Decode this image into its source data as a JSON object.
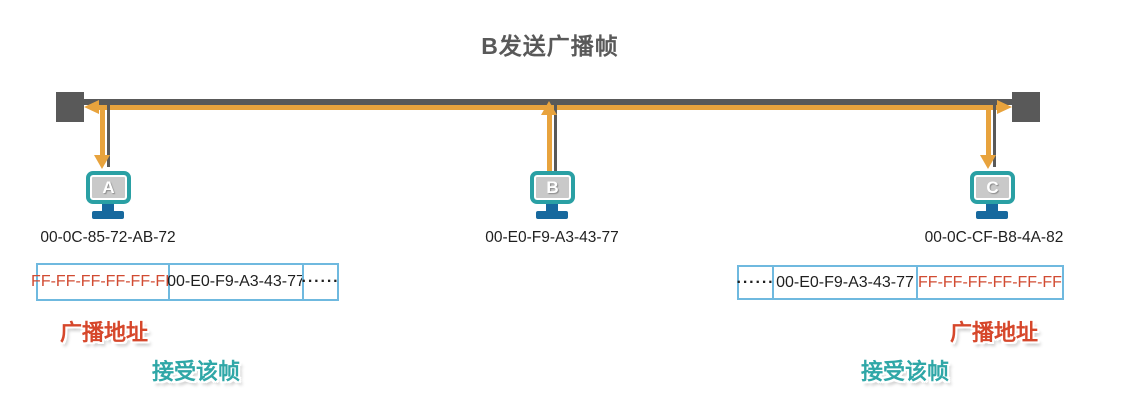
{
  "title": "B发送广播帧",
  "palette": {
    "bus_gray": "#595959",
    "signal_yellow": "#E8A33D",
    "monitor_teal": "#2AA0A4",
    "monitor_screen_gray": "#C9C9C9",
    "stand_blue": "#17699E",
    "frame_border_blue": "#6FB9DF",
    "broadcast_red": "#D6472B",
    "accept_teal": "#2FA7A7"
  },
  "computers": [
    {
      "name": "A",
      "mac": "00-0C-85-72-AB-72",
      "signal_direction": "receive-down"
    },
    {
      "name": "B",
      "mac": "00-E0-F9-A3-43-77",
      "signal_direction": "send-up"
    },
    {
      "name": "C",
      "mac": "00-0C-CF-B8-4A-82",
      "signal_direction": "receive-down"
    }
  ],
  "frame_left": {
    "dest": "FF-FF-FF-FF-FF-FF",
    "src": "00-E0-F9-A3-43-77",
    "rest": "······",
    "label_broadcast": "广播地址",
    "label_accept": "接受该帧"
  },
  "frame_right": {
    "rest": "······",
    "src": "00-E0-F9-A3-43-77",
    "dest": "FF-FF-FF-FF-FF-FF",
    "label_broadcast": "广播地址",
    "label_accept": "接受该帧"
  }
}
